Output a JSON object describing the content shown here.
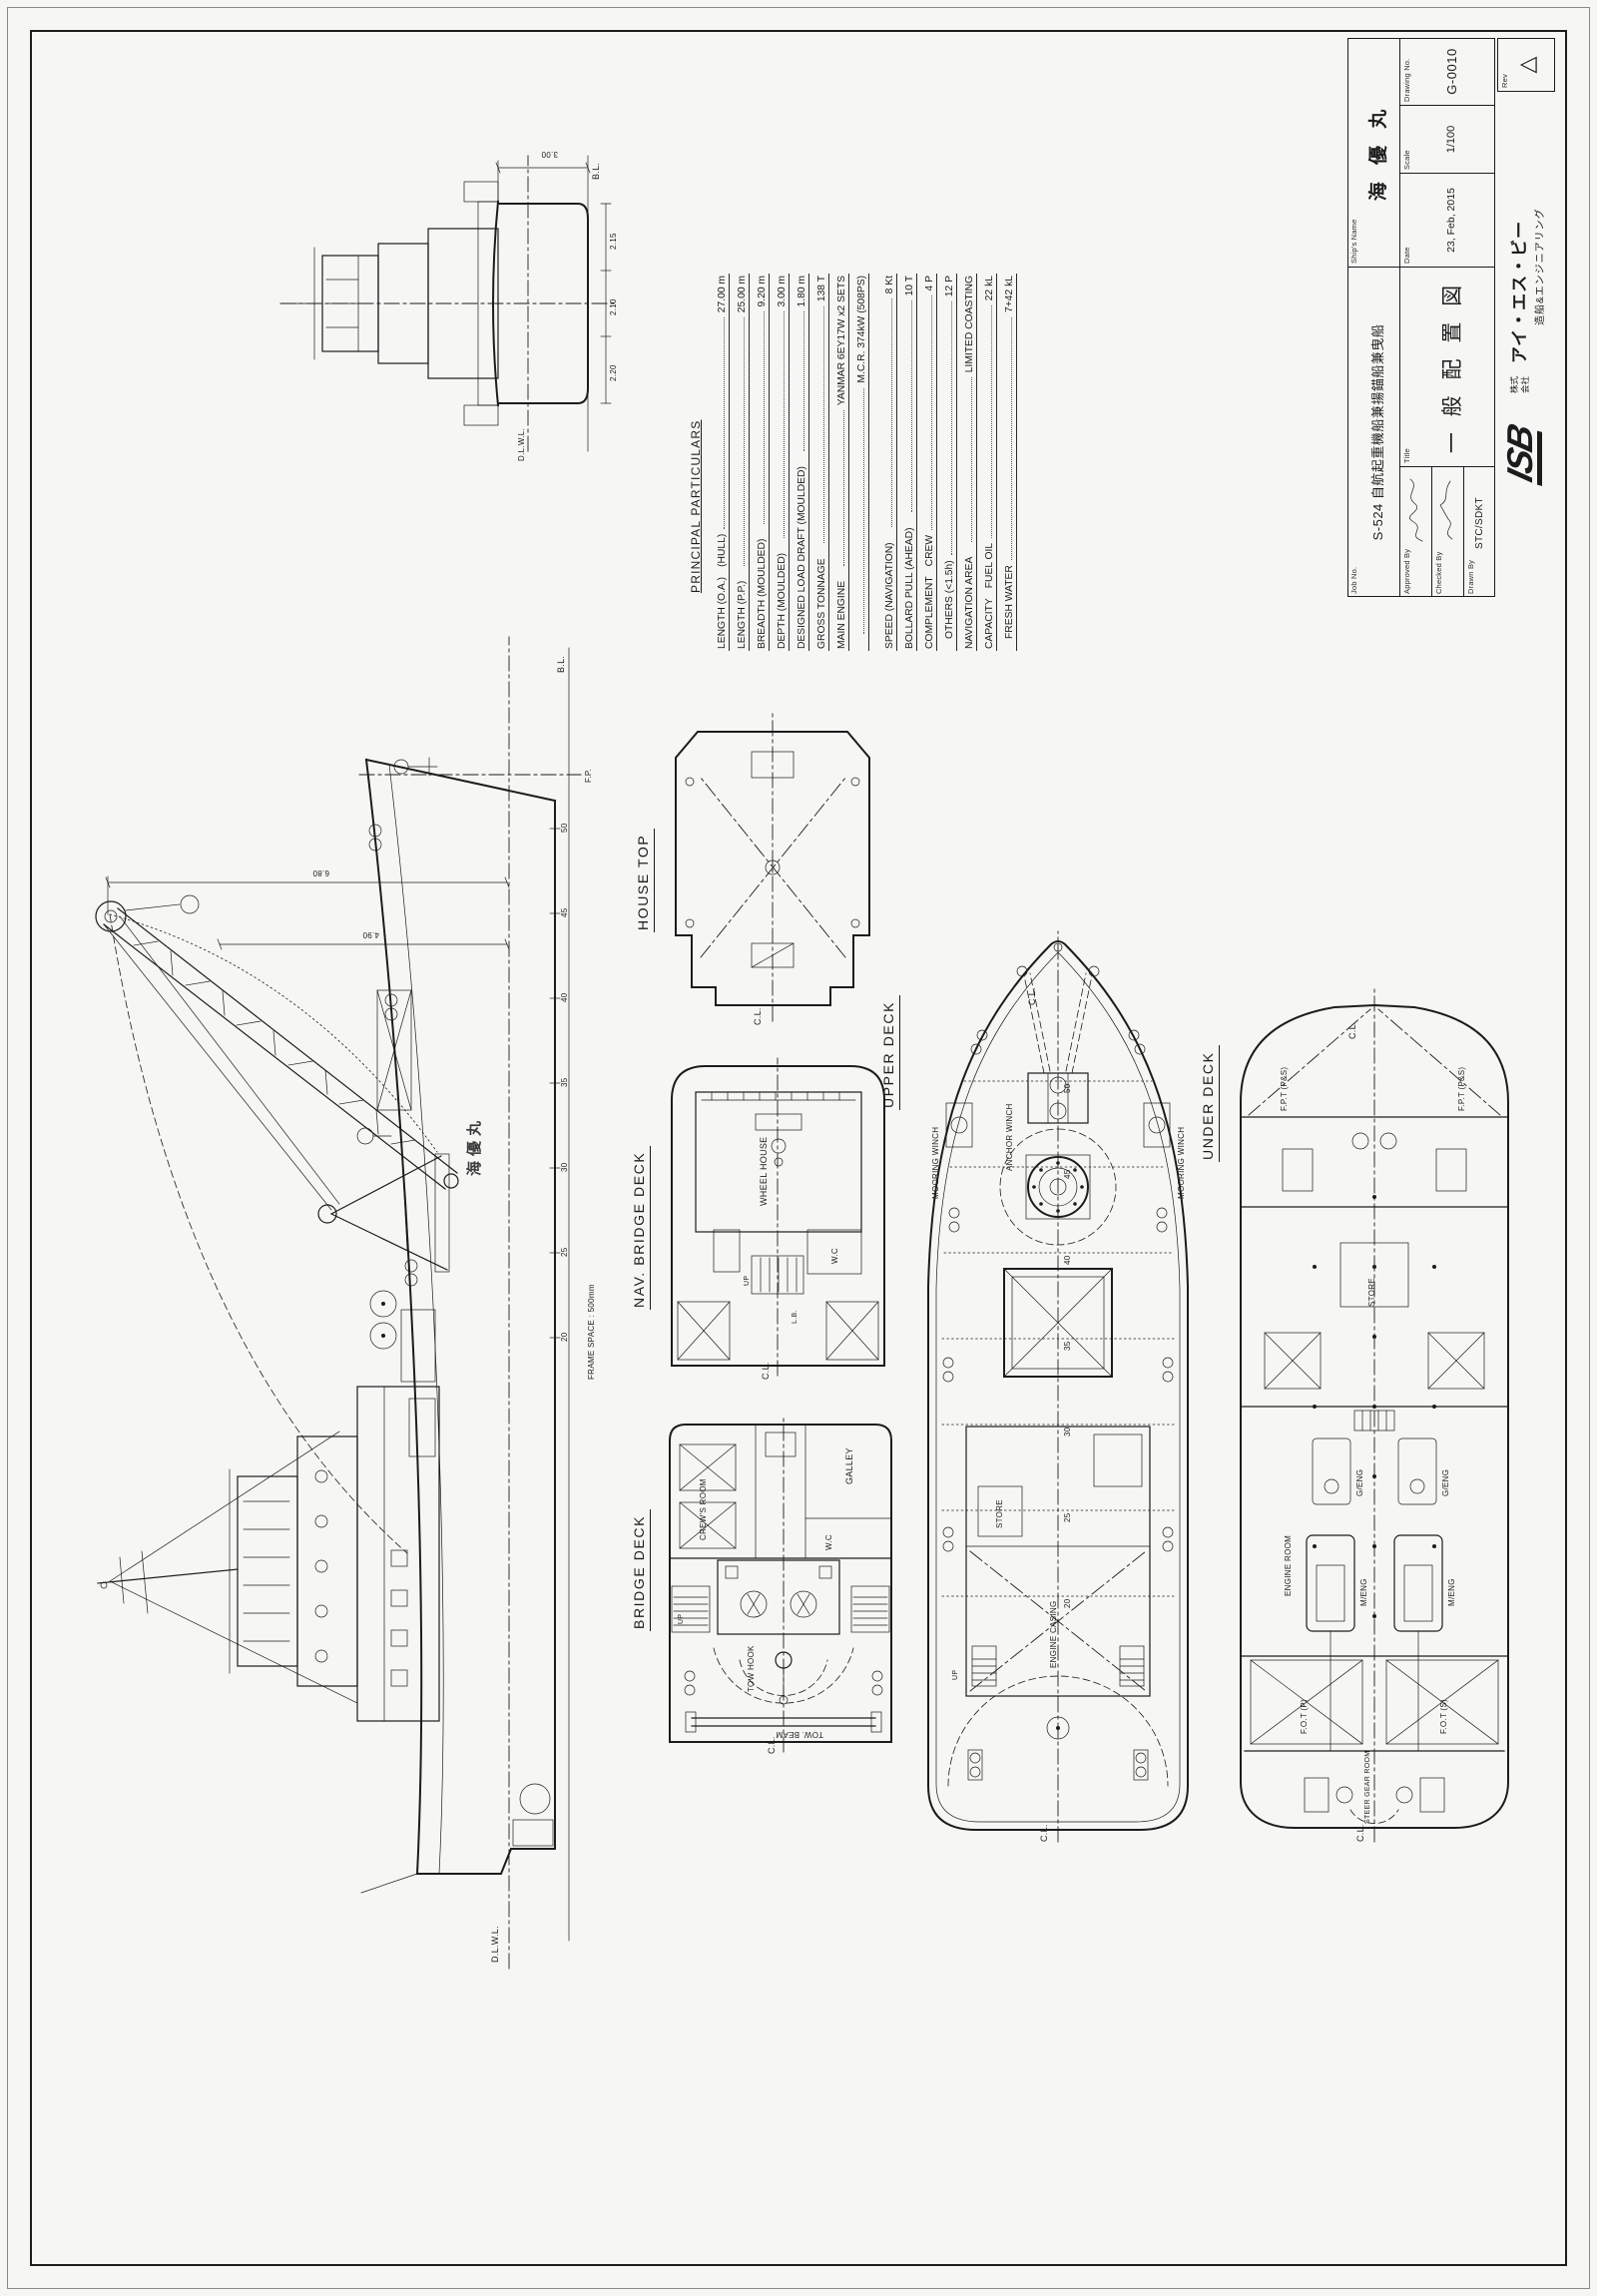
{
  "sheet": {
    "paper": "#f6f6f4",
    "ink": "#1c1c1c"
  },
  "titleblock": {
    "job_no_label": "Job No.",
    "job_no": "S-524  自航起重機船兼揚錨船兼曳船",
    "ship_name_label": "Ship's Name",
    "ship_name": "海 優 丸",
    "title_label": "Title",
    "drawing_title": "一 般 配 置 図",
    "approved_label": "Approved By",
    "checked_label": "Checked By",
    "drawn_label": "Drawn By",
    "drawn_by": "STC/SDKT",
    "date_label": "Date",
    "date": "23, Feb, 2015",
    "scale_label": "Scale",
    "scale": "1/100",
    "dwg_no_label": "Drawing No.",
    "dwg_no": "G-0010",
    "rev_label": "Rev",
    "rev_mark": "△",
    "logo_text": "ISB",
    "company_kk1": "株式",
    "company_kk2": "会社",
    "company_name": "アイ・エス・ビー",
    "company_sub": "造船&エンジニアリング"
  },
  "particulars": {
    "title": "PRINCIPAL PARTICULARS",
    "rows": [
      {
        "l": "LENGTH  (O.A.)",
        "s": "(HULL)",
        "v": "27.00 m"
      },
      {
        "l": "LENGTH  (P.P.)",
        "s": "",
        "v": "25.00 m"
      },
      {
        "l": "BREADTH (MOULDED)",
        "s": "",
        "v": "9.20 m"
      },
      {
        "l": "DEPTH   (MOULDED)",
        "s": "",
        "v": "3.00 m"
      },
      {
        "l": "DESIGNED LOAD DRAFT (MOULDED)",
        "s": "",
        "v": "1.80 m"
      },
      {
        "l": "GROSS TONNAGE",
        "s": "",
        "v": "138 T"
      },
      {
        "l": "MAIN ENGINE",
        "s": "",
        "v": "YANMAR  6EY17W  x2 SETS"
      },
      {
        "l": "",
        "s": "",
        "v": "M.C.R. 374kW (508PS)"
      },
      {
        "l": "SPEED (NAVIGATION)",
        "s": "",
        "v": "8 Kt"
      },
      {
        "l": "BOLLARD PULL  (AHEAD)",
        "s": "",
        "v": "10 T"
      },
      {
        "l": "COMPLEMENT",
        "s": "CREW",
        "v": "4 P"
      },
      {
        "l": "",
        "s": "OTHERS (<1.5h)",
        "v": "12 P"
      },
      {
        "l": "NAVIGATION AREA",
        "s": "",
        "v": "LIMITED COASTING"
      },
      {
        "l": "CAPACITY",
        "s": "FUEL OIL",
        "v": "22 kL"
      },
      {
        "l": "",
        "s": "FRESH WATER",
        "v": "7+42 kL"
      }
    ]
  },
  "views": {
    "house_top": "HOUSE TOP",
    "nav_bridge": "NAV. BRIDGE DECK",
    "bridge": "BRIDGE DECK",
    "upper": "UPPER DECK",
    "under": "UNDER DECK"
  },
  "labels": {
    "cl": "C.L.",
    "bl": "B.L.",
    "dlwl": "D.L.W.L.",
    "fp": "F.P.",
    "lb": "L.B.",
    "frame_space": "FRAME SPACE : 500mm",
    "wheel_house": "WHEEL HOUSE",
    "wc": "W.C",
    "galley": "GALLEY",
    "crews_room": "CREW'S ROOM",
    "store": "STORE",
    "engine_room": "ENGINE ROOM",
    "engine_casing": "ENGINE CASING",
    "steer_gear": "STEER GEAR ROOM",
    "m_eng": "M/ENG",
    "g_eng": "G/ENG",
    "anchor_winch": "ANCHOR WINCH",
    "mooring_winch": "MOORING WINCH",
    "tow_hook": "TOW HOOK",
    "tow_beam": "TOW. BEAM",
    "fpt": "F.P.T (P&S)",
    "fot_p": "F.O.T (P)",
    "fot_s": "F.O.T (S)",
    "hull_name": "海優丸",
    "up": "UP",
    "dim_680": "6.80",
    "dim_490": "4.90",
    "dim_300": "3.00",
    "dim_220": "2.20",
    "dim_210": "2.10",
    "dim_215": "2.15",
    "frames": [
      "20",
      "25",
      "30",
      "35",
      "40",
      "45",
      "50"
    ]
  }
}
